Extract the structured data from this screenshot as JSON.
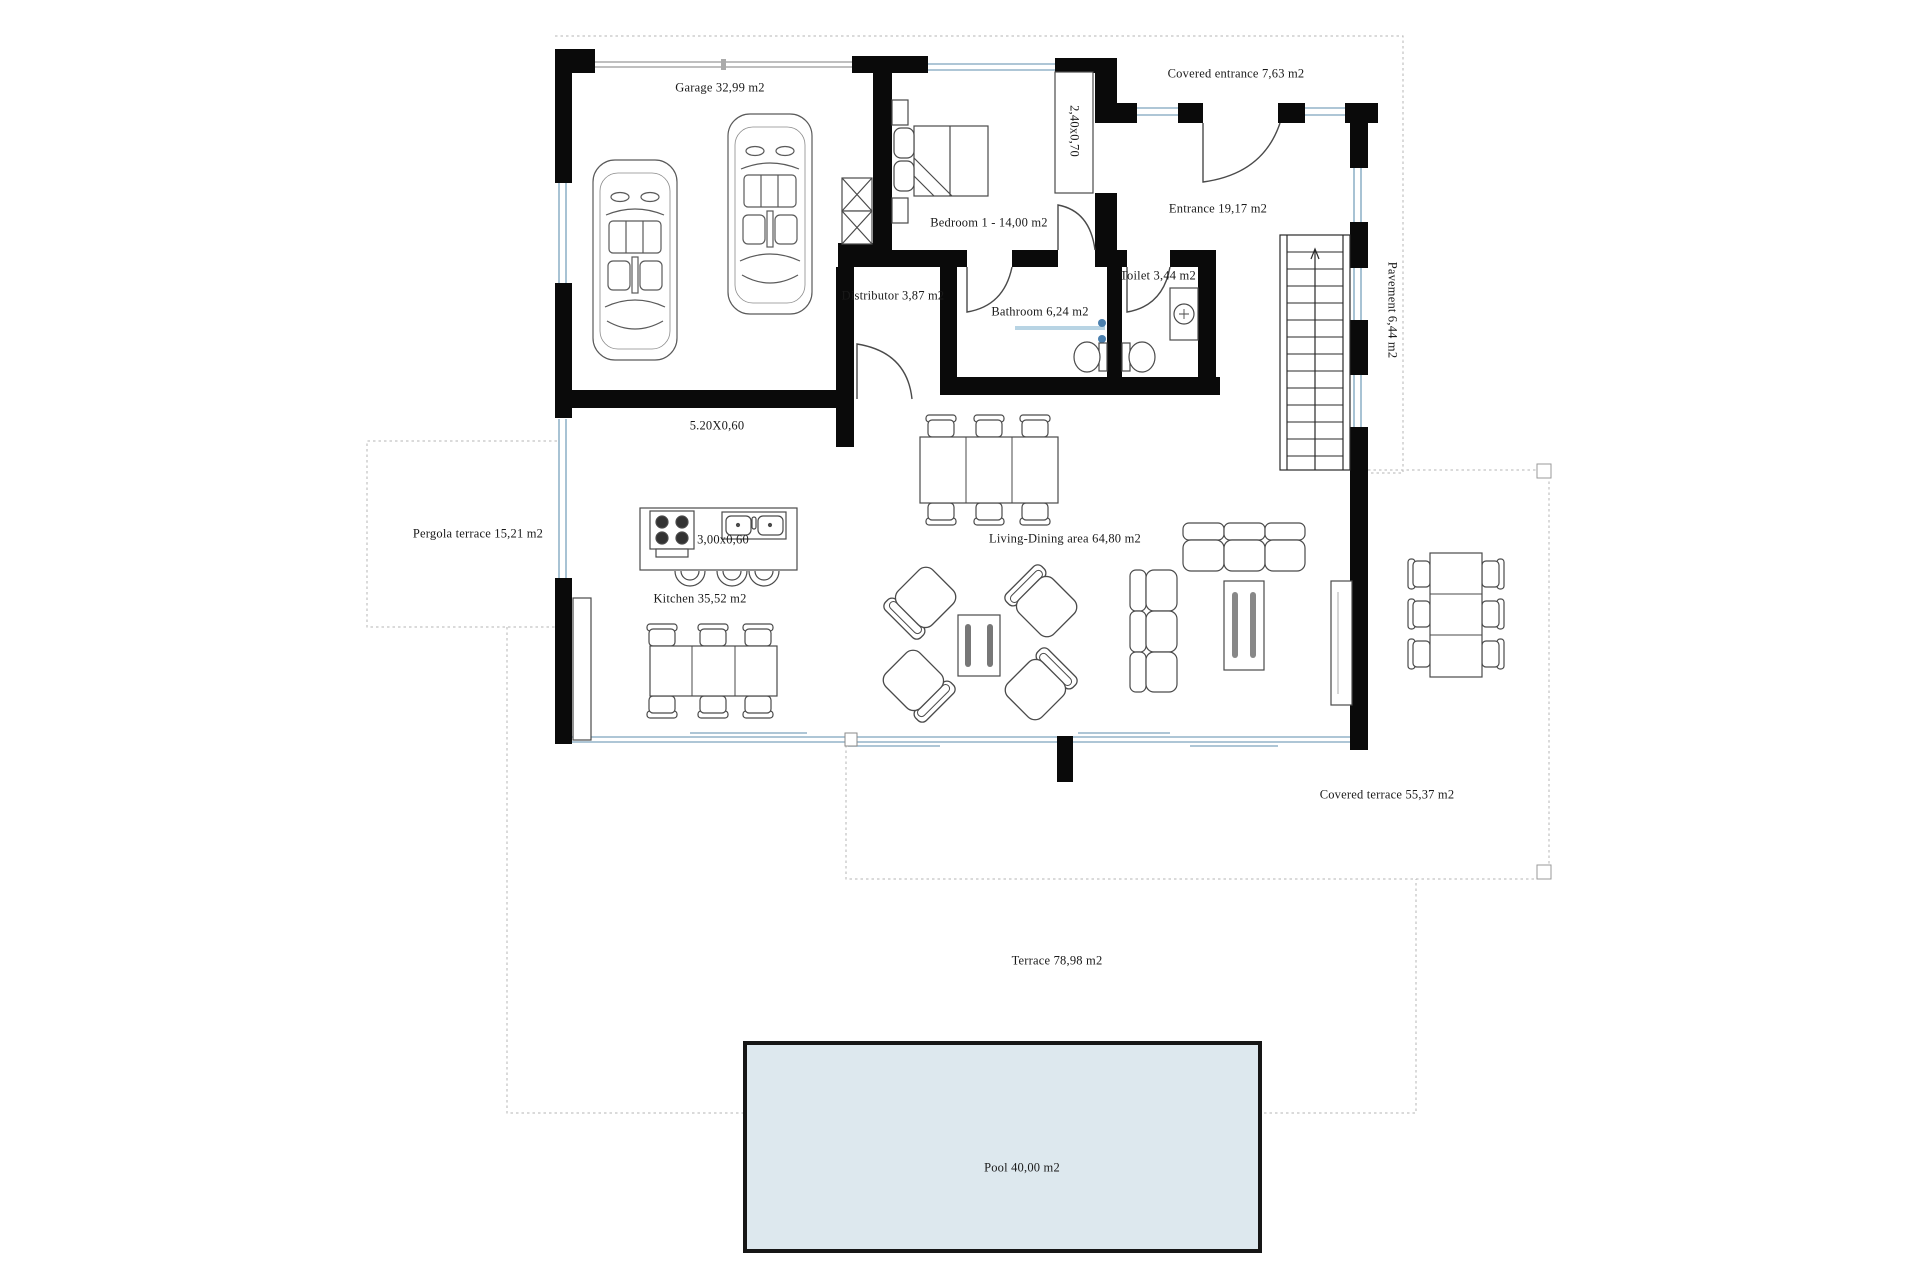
{
  "canvas": {
    "width": 1920,
    "height": 1280,
    "background": "#ffffff"
  },
  "colors": {
    "wall": "#0a0a0a",
    "window": "#93b4c9",
    "garage_door": "#aaaaaa",
    "dashed_boundary": "#b5b5b5",
    "furniture_line": "#4a4a4a",
    "pool_fill": "#dde8ee",
    "pool_border": "#161616",
    "text": "#1a1a1a",
    "fixture_blue": "#4a7fae"
  },
  "labels": [
    {
      "id": "garage",
      "text": "Garage 32,99 m2",
      "x": 720,
      "y": 88,
      "rotate": false
    },
    {
      "id": "covered-entrance",
      "text": "Covered entrance 7,63 m2",
      "x": 1236,
      "y": 74,
      "rotate": false
    },
    {
      "id": "closet-dim",
      "text": "2,40x0,70",
      "x": 1074,
      "y": 131,
      "rotate": true
    },
    {
      "id": "bedroom-1",
      "text": "Bedroom 1 - 14,00 m2",
      "x": 989,
      "y": 223,
      "rotate": false
    },
    {
      "id": "entrance",
      "text": "Entrance 19,17 m2",
      "x": 1218,
      "y": 209,
      "rotate": false
    },
    {
      "id": "distributor",
      "text": "Distributor 3,87 m2",
      "x": 893,
      "y": 296,
      "rotate": false
    },
    {
      "id": "toilet",
      "text": "Toilet 3,44 m2",
      "x": 1158,
      "y": 276,
      "rotate": false
    },
    {
      "id": "bathroom",
      "text": "Bathroom 6,24 m2",
      "x": 1040,
      "y": 312,
      "rotate": false
    },
    {
      "id": "pavement",
      "text": "Pavement 6,44 m2",
      "x": 1392,
      "y": 310,
      "rotate": true
    },
    {
      "id": "garage-wall-dim",
      "text": "5.20X0,60",
      "x": 717,
      "y": 426,
      "rotate": false
    },
    {
      "id": "pergola-terrace",
      "text": "Pergola terrace 15,21 m2",
      "x": 478,
      "y": 534,
      "rotate": false
    },
    {
      "id": "island-dim",
      "text": "3,00x0,60",
      "x": 723,
      "y": 540,
      "rotate": false
    },
    {
      "id": "kitchen",
      "text": "Kitchen 35,52 m2",
      "x": 700,
      "y": 599,
      "rotate": false
    },
    {
      "id": "living-dining",
      "text": "Living-Dining area 64,80 m2",
      "x": 1065,
      "y": 539,
      "rotate": false
    },
    {
      "id": "covered-terrace",
      "text": "Covered terrace 55,37 m2",
      "x": 1387,
      "y": 795,
      "rotate": false
    },
    {
      "id": "terrace",
      "text": "Terrace 78,98 m2",
      "x": 1057,
      "y": 961,
      "rotate": false
    },
    {
      "id": "pool",
      "text": "Pool 40,00 m2",
      "x": 1022,
      "y": 1168,
      "rotate": false
    }
  ]
}
